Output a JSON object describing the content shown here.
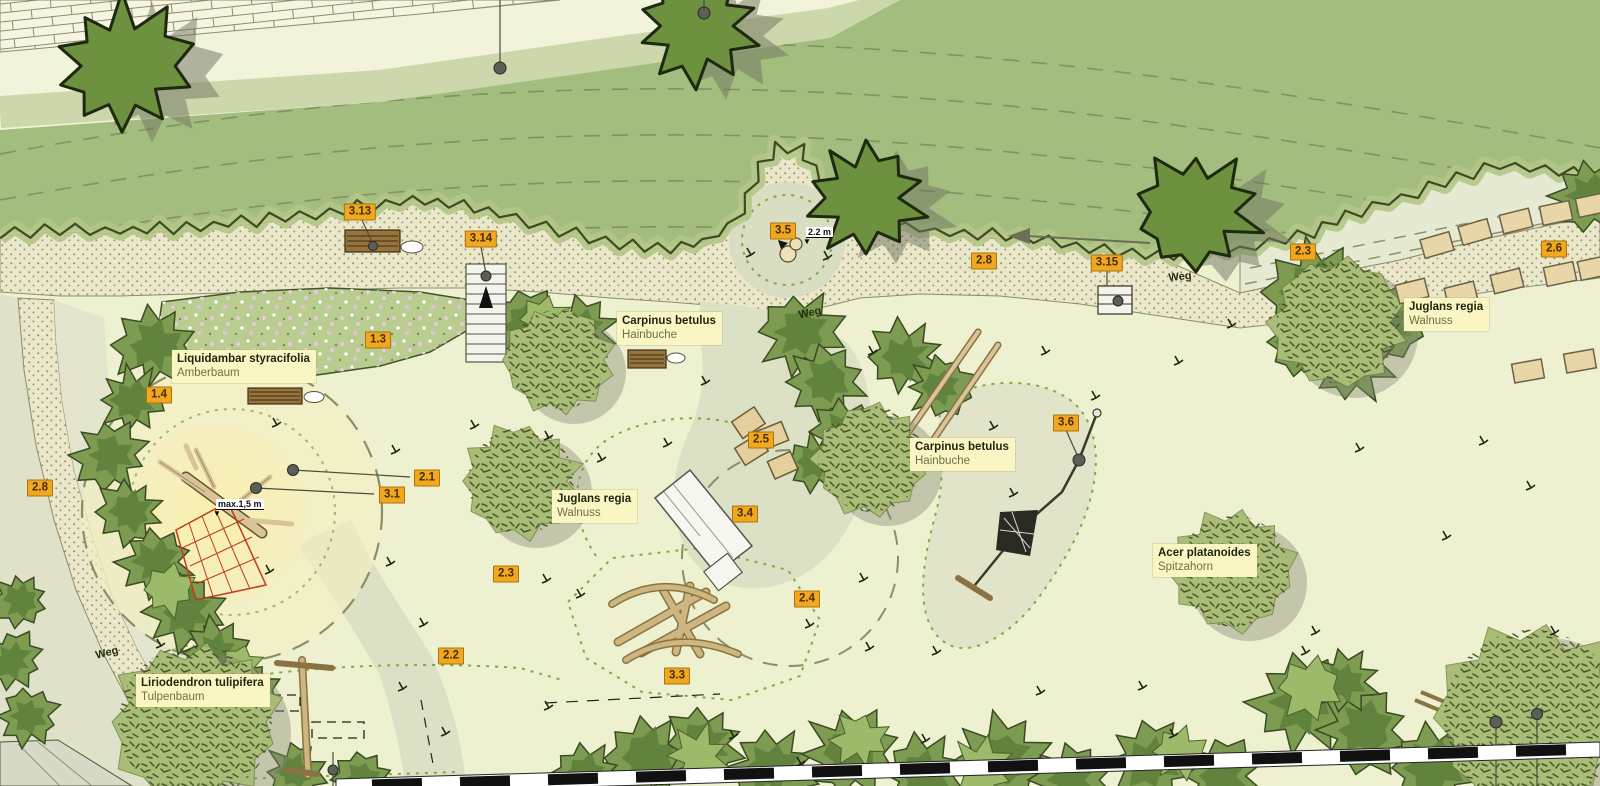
{
  "plan": {
    "tags": [
      {
        "label": "3.13",
        "x": 360,
        "y": 212
      },
      {
        "label": "3.14",
        "x": 481,
        "y": 239
      },
      {
        "label": "1.3",
        "x": 378,
        "y": 340
      },
      {
        "label": "1.4",
        "x": 159,
        "y": 395
      },
      {
        "label": "2.8",
        "x": 40,
        "y": 488
      },
      {
        "label": "3.5",
        "x": 783,
        "y": 231
      },
      {
        "label": "2.8",
        "x": 984,
        "y": 261
      },
      {
        "label": "3.15",
        "x": 1107,
        "y": 263
      },
      {
        "label": "2.3",
        "x": 1303,
        "y": 252
      },
      {
        "label": "2.6",
        "x": 1554,
        "y": 249
      },
      {
        "label": "2.1",
        "x": 427,
        "y": 478
      },
      {
        "label": "3.1",
        "x": 392,
        "y": 495
      },
      {
        "label": "2.5",
        "x": 761,
        "y": 440
      },
      {
        "label": "3.4",
        "x": 745,
        "y": 514
      },
      {
        "label": "2.4",
        "x": 807,
        "y": 599
      },
      {
        "label": "3.6",
        "x": 1066,
        "y": 423
      },
      {
        "label": "2.3",
        "x": 506,
        "y": 574
      },
      {
        "label": "2.2",
        "x": 451,
        "y": 656
      },
      {
        "label": "3.3",
        "x": 677,
        "y": 676
      }
    ],
    "plants": [
      {
        "latin": "Liquidambar styracifolia",
        "german": "Amberbaum",
        "x": 172,
        "y": 350
      },
      {
        "latin": "Carpinus betulus",
        "german": "Hainbuche",
        "x": 617,
        "y": 312
      },
      {
        "latin": "Juglans regia",
        "german": "Walnuss",
        "x": 1404,
        "y": 298
      },
      {
        "latin": "Juglans regia",
        "german": "Walnuss",
        "x": 552,
        "y": 490
      },
      {
        "latin": "Carpinus betulus",
        "german": "Hainbuche",
        "x": 910,
        "y": 438
      },
      {
        "latin": "Acer platanoides",
        "german": "Spitzahorn",
        "x": 1153,
        "y": 544
      },
      {
        "latin": "Liriodendron tulipifera",
        "german": "Tulpenbaum",
        "x": 136,
        "y": 674
      }
    ],
    "path_labels": [
      {
        "label": "Weg",
        "x": 810,
        "y": 313,
        "rot": -12
      },
      {
        "label": "Weg",
        "x": 1180,
        "y": 277,
        "rot": -6
      },
      {
        "label": "Weg",
        "x": 107,
        "y": 653,
        "rot": -14
      }
    ],
    "measures": [
      {
        "label": "2.2 m",
        "x": 806,
        "y": 227
      },
      {
        "label": "max.1,5 m",
        "x": 216,
        "y": 499
      }
    ],
    "colors": {
      "tag_bg": "#f2a71f",
      "plant_label_bg": "#faf6c4",
      "meadow_green": "#a3bd7e",
      "gravel": "#ebe7ca",
      "playground": "#eef1d0",
      "tree_dark": "#6d913e",
      "dotted_green": "#7fa945"
    }
  }
}
